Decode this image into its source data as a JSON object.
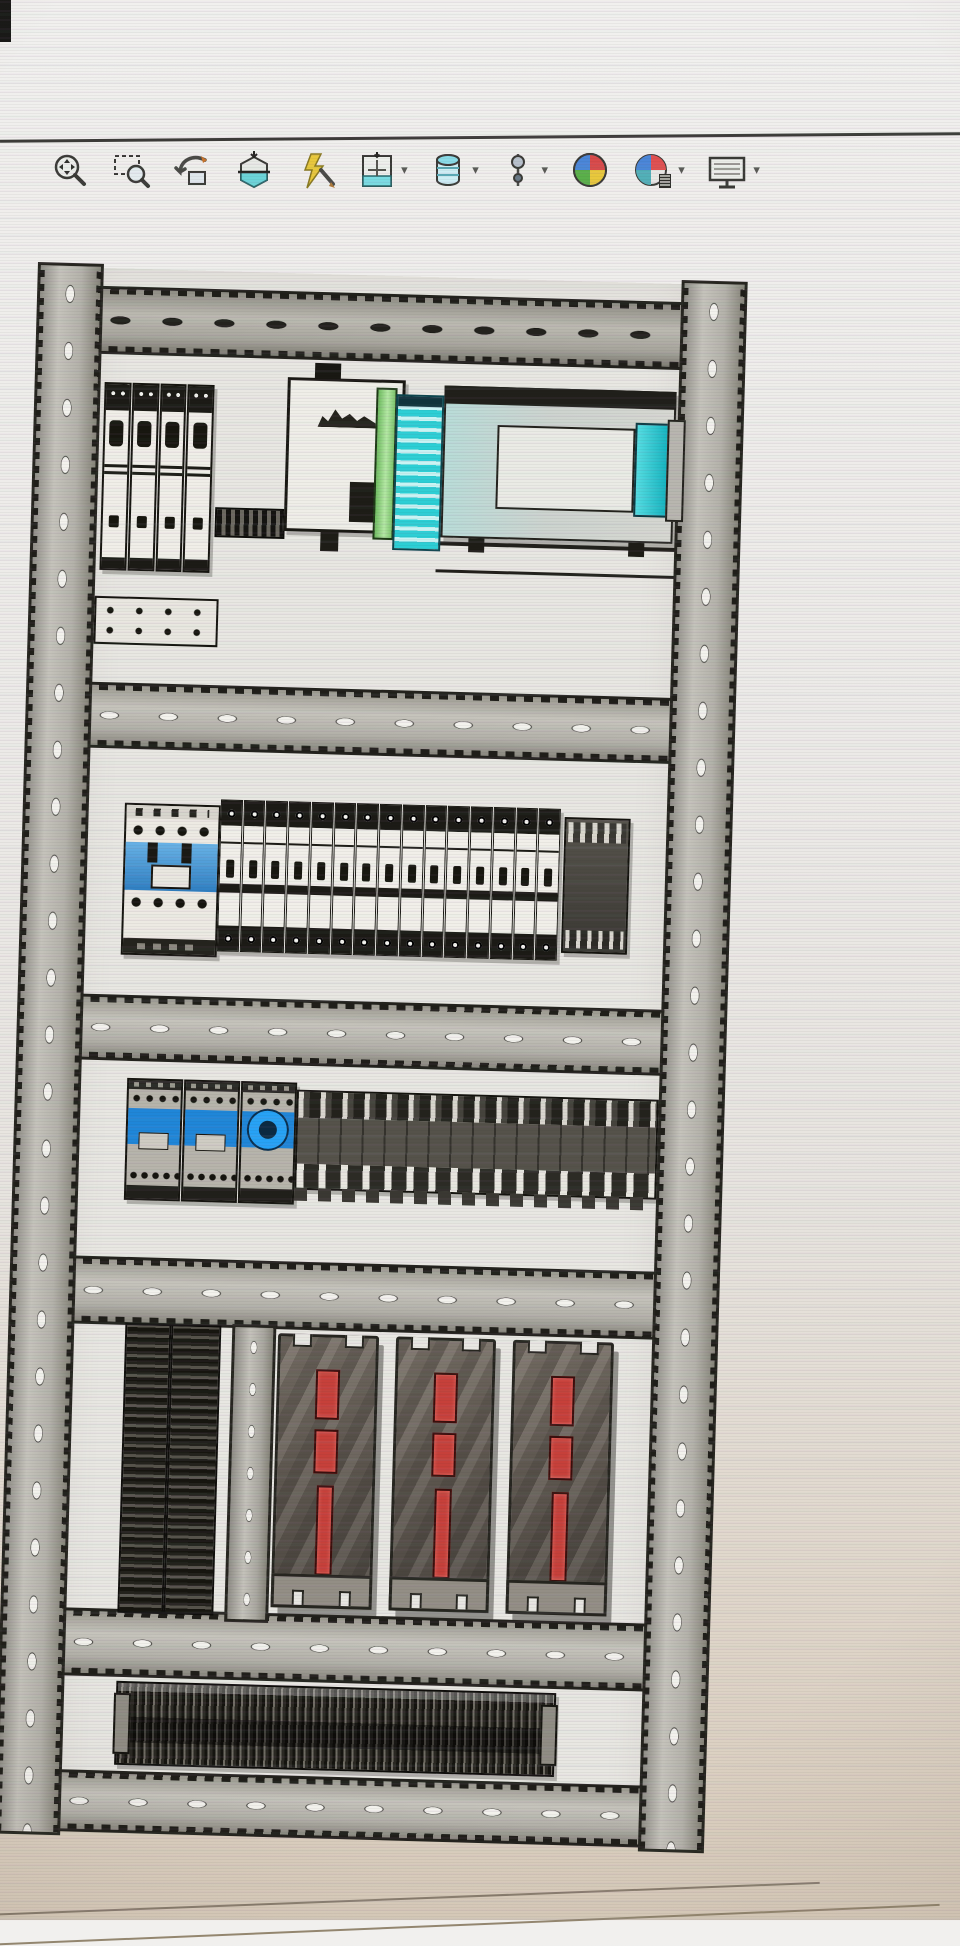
{
  "toolbar": {
    "caret": "▾",
    "icons": [
      {
        "name": "zoom-to-fit",
        "dropdown": false
      },
      {
        "name": "zoom-to-area",
        "dropdown": false
      },
      {
        "name": "previous-view",
        "dropdown": false
      },
      {
        "name": "section-view",
        "dropdown": false
      },
      {
        "name": "3d-drawing-view",
        "dropdown": false
      },
      {
        "name": "view-orientation",
        "dropdown": true
      },
      {
        "name": "display-style",
        "dropdown": true
      },
      {
        "name": "hide-show-items",
        "dropdown": true
      },
      {
        "name": "edit-appearance",
        "dropdown": false
      },
      {
        "name": "apply-scene",
        "dropdown": true
      },
      {
        "name": "view-settings",
        "dropdown": true
      }
    ]
  },
  "panel": {
    "colors": {
      "contactor-blue": "#3a8cd2",
      "contactor3-blue": "#1f86d8",
      "ring-blue": "#27a2f5",
      "cyan": "#35d4da",
      "green": "#8ed07e",
      "servo-red": "#c6403a",
      "rail-gray": "#b3b1a9",
      "dark": "#1c1b16"
    },
    "row1": {
      "breaker_count": 4
    },
    "row2": {
      "breaker_count": 15
    },
    "row3": {
      "contactor_count": 3
    },
    "row4": {
      "drive_count": 3
    }
  }
}
